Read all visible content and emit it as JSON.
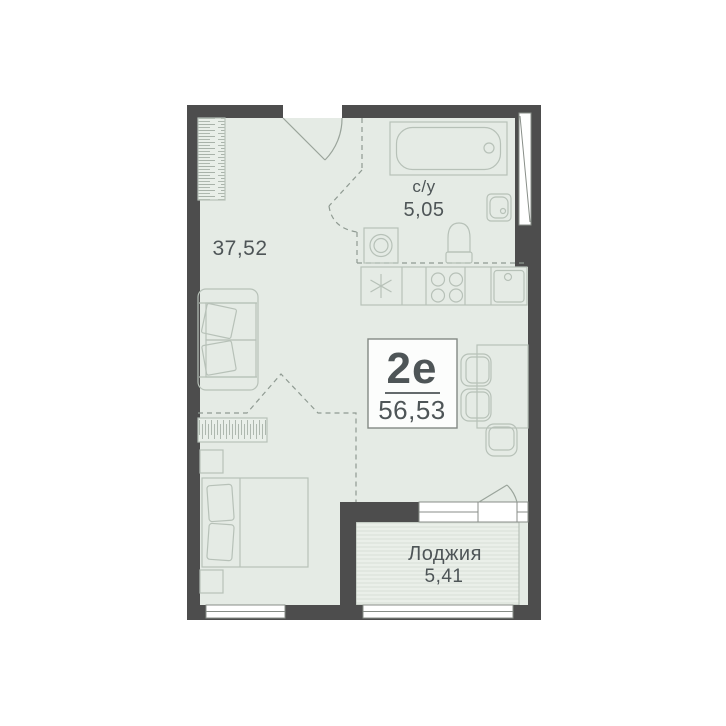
{
  "plan": {
    "labels": {
      "main_area": "37,52",
      "bathroom_name": "с/у",
      "bathroom_area": "5,05",
      "unit_type": "2е",
      "unit_area": "56,53",
      "loggia_name": "Лоджия",
      "loggia_area": "5,41"
    },
    "colors": {
      "wall": "#4d4d4d",
      "floor": "#e5ebe5",
      "furniture_outline": "#b7c1b8",
      "dashed_zone": "#8f9a92",
      "text": "#4e5557",
      "window": "#ffffff",
      "label_box_fill": "#fcfdfc",
      "label_box_border": "#838984",
      "loggia_stripe": "#d8dfd7"
    },
    "symbols": [
      "wardrobe-symbol",
      "entrance-door-symbol",
      "bathtub-symbol",
      "bathroom-sink-symbol",
      "toilet-symbol",
      "washing-machine-symbol",
      "fridge-symbol",
      "stove-symbol",
      "kitchen-sink-symbol",
      "sofa-symbol",
      "dresser-symbol",
      "nightstand-symbol",
      "bed-symbol",
      "table-symbol",
      "chair-symbol",
      "loggia-door-symbol",
      "window-symbol"
    ]
  }
}
